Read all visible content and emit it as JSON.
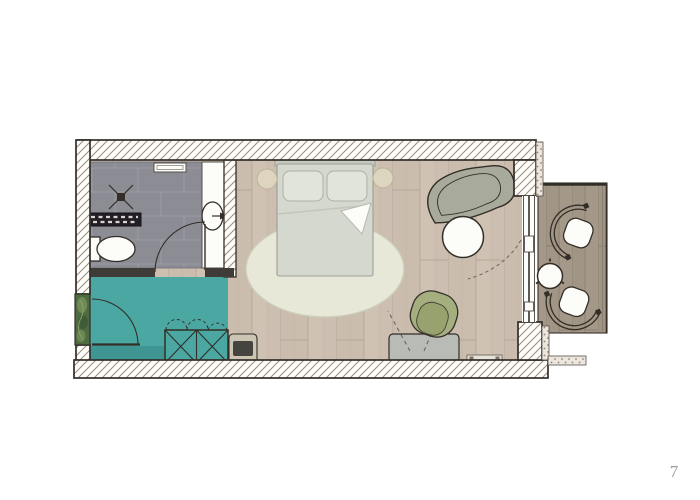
{
  "page": {
    "number": "7"
  },
  "colors": {
    "outline": "#332e28",
    "wall_hatch_line": "#988d81",
    "wall_fill": "#fdfcf8",
    "tile": "#8c8c94",
    "tile_grout": "#9d9da6",
    "teal": "#4aa7a2",
    "teal_dark": "#3e9591",
    "wood": "#cfc2b3",
    "wood_line": "#b2a192",
    "deck": "#a49888",
    "deck_line": "#8c8071",
    "rug": "#e8e8d9",
    "rug_edge": "#cccdb9",
    "bed": "#d5d8cf",
    "bed_edge": "#9aa094",
    "pillow": "#e1e4db",
    "headboard": "#c6c9bf",
    "stool": "#ddd5bf",
    "stool_edge": "#bdb294",
    "sofa": "#a8ab9c",
    "armchair": "#a5ae7e",
    "armchair_dark": "#96a06c",
    "desk": "#b9bbb6",
    "luggage": "#cdc5b4",
    "suitcase": "#45443f",
    "white_fixture": "#fcfcf9",
    "dark_bar": "#241f26",
    "dark_bar_dash": "#d8d4cf",
    "plant": "#4e6b42",
    "plant_light": "#79935d",
    "stipple_fill": "#ece6dd",
    "stipple_dot": "#8d8378",
    "partition_dark": "#3f3b36",
    "page_number_color": "#9b9b9b"
  },
  "floorplan": {
    "kind": "hotel-guestroom-floor-plan",
    "rooms": [
      {
        "name": "bathroom",
        "features": [
          "shower-drain",
          "towel-radiator",
          "toilet",
          "washbasin-counter",
          "wall-niche",
          "door-swing"
        ]
      },
      {
        "name": "entry",
        "features": [
          "entrance-door-swing",
          "plant",
          "wardrobe",
          "doormat"
        ]
      },
      {
        "name": "bedroom",
        "features": [
          "double-bed",
          "pillows",
          "bedside-stools",
          "area-rug",
          "sofa",
          "coffee-table",
          "armchair",
          "desk",
          "luggage-rack",
          "wall-radiator",
          "sliding-window",
          "curtain-swing"
        ]
      },
      {
        "name": "balcony",
        "features": [
          "wood-deck",
          "lounge-chair",
          "lounge-chair",
          "side-table",
          "railing"
        ]
      }
    ]
  }
}
